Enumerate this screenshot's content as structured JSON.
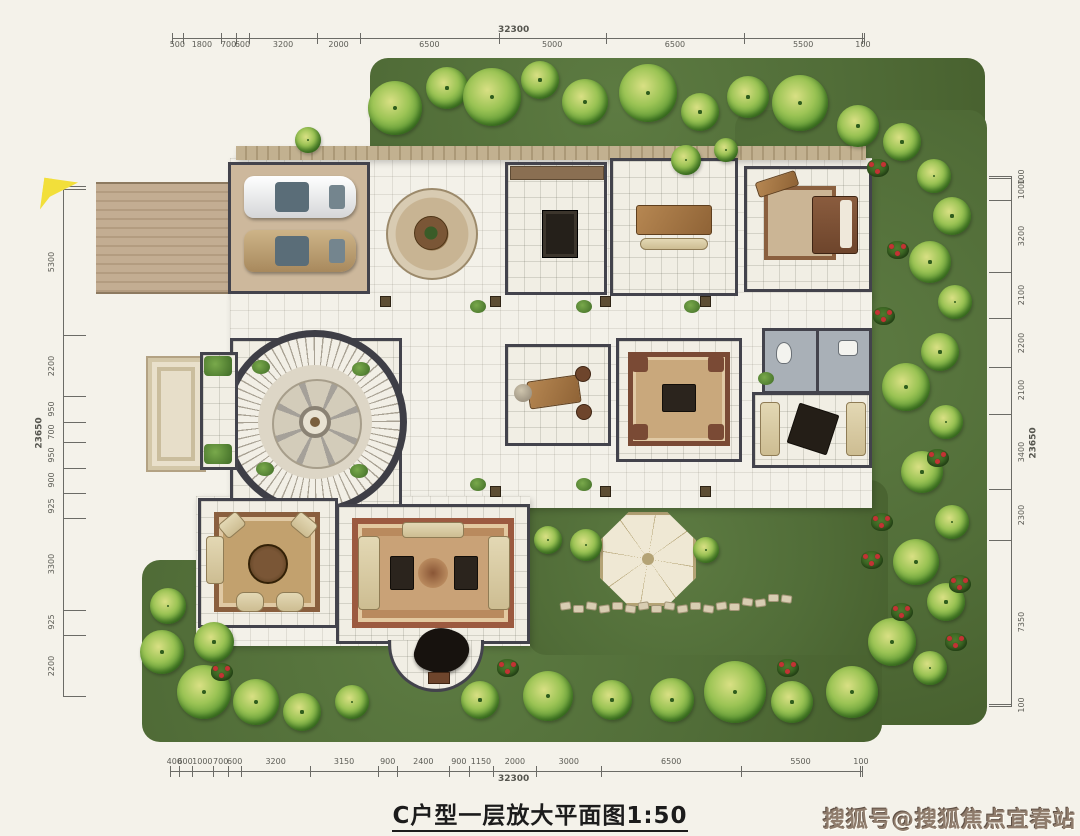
{
  "title": {
    "text": "C户型一层放大平面图1:50"
  },
  "watermark": {
    "text": "搜狐号@搜狐焦点宜春站"
  },
  "dimensions": {
    "top": {
      "total": "32300",
      "segments": [
        "500",
        "1800",
        "700",
        "600",
        "3200",
        "2000",
        "6500",
        "5000",
        "6500",
        "5500",
        "100"
      ]
    },
    "bottom": {
      "total": "32300",
      "segments": [
        "400",
        "600",
        "1000",
        "700",
        "600",
        "3200",
        "3150",
        "900",
        "2400",
        "900",
        "1150",
        "2000",
        "3000",
        "6500",
        "5500",
        "100"
      ]
    },
    "left": {
      "total": "23650",
      "segments": [
        "100",
        "5300",
        "2200",
        "950",
        "700",
        "950",
        "900",
        "925",
        "3300",
        "925",
        "2200"
      ]
    },
    "right": {
      "total": "23650",
      "segments": [
        "100",
        "1000",
        "3200",
        "2100",
        "2200",
        "2100",
        "3400",
        "2300",
        "7350",
        "100"
      ]
    }
  },
  "colors": {
    "paper": "#f4f2ea",
    "grass": "#51703a",
    "wall": "#43434c",
    "wood": "#a97c4f",
    "highlight_marker": "#f2df3a",
    "watermark_red_brown": "#8f7c6c"
  }
}
